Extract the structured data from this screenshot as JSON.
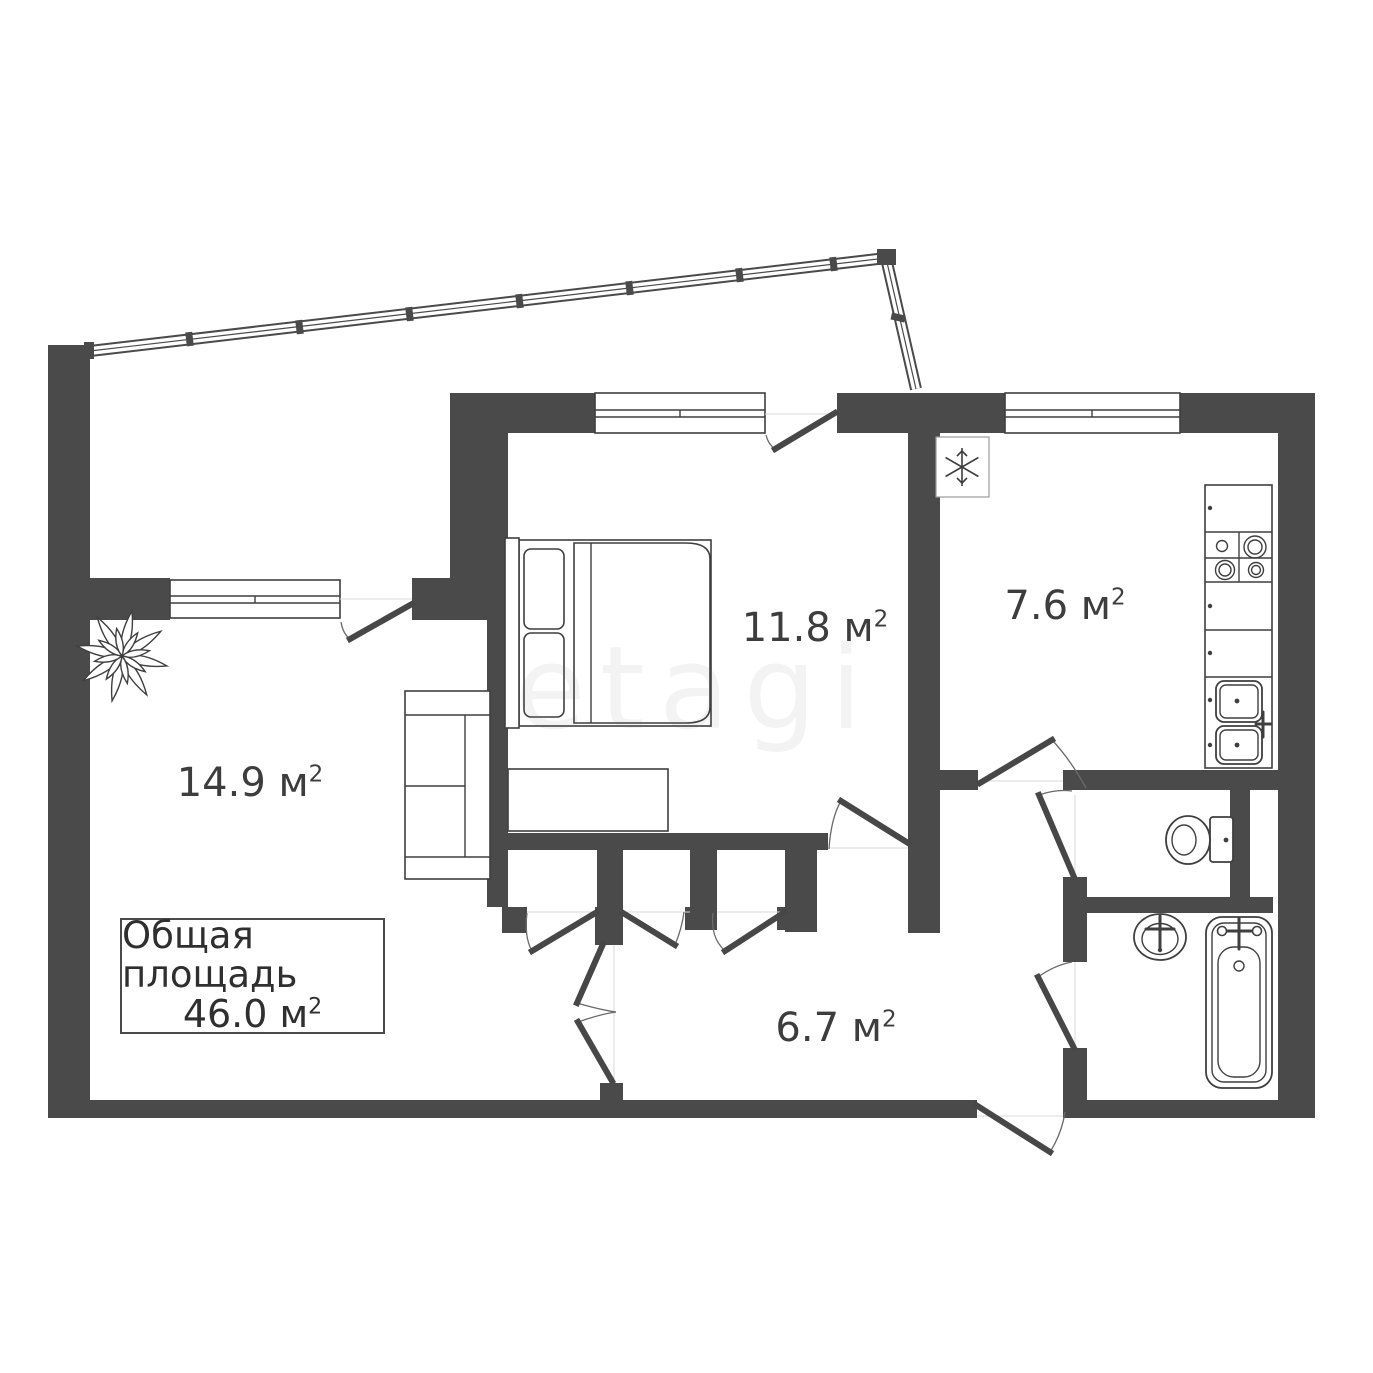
{
  "document": {
    "kind": "apartment-floor-plan",
    "background": "#ffffff"
  },
  "colors": {
    "wall": "#4a4a4a",
    "outline": "#3f3f3f",
    "text": "#3d3d3d",
    "door_arc": "#6a6a6a",
    "hairline": "#d8d8d8"
  },
  "unit_sup": "2",
  "total": {
    "label": "Общая площадь",
    "value": "46.0 м"
  },
  "rooms": [
    {
      "id": "living-room",
      "label": "14.9 м"
    },
    {
      "id": "bedroom",
      "label": "11.8 м"
    },
    {
      "id": "kitchen",
      "label": "7.6 м"
    },
    {
      "id": "hallway",
      "label": "6.7 м"
    }
  ],
  "watermark": "etagi",
  "fixtures": [
    "balcony-railing",
    "snowflake-fridge-icon",
    "stove-burners-icon",
    "kitchen-double-sink-icon",
    "double-bed-icon",
    "sofa-icon",
    "plant-icon",
    "wardrobe-closet-doors",
    "toilet-icon",
    "wash-basin-icon",
    "bathtub-icon"
  ]
}
